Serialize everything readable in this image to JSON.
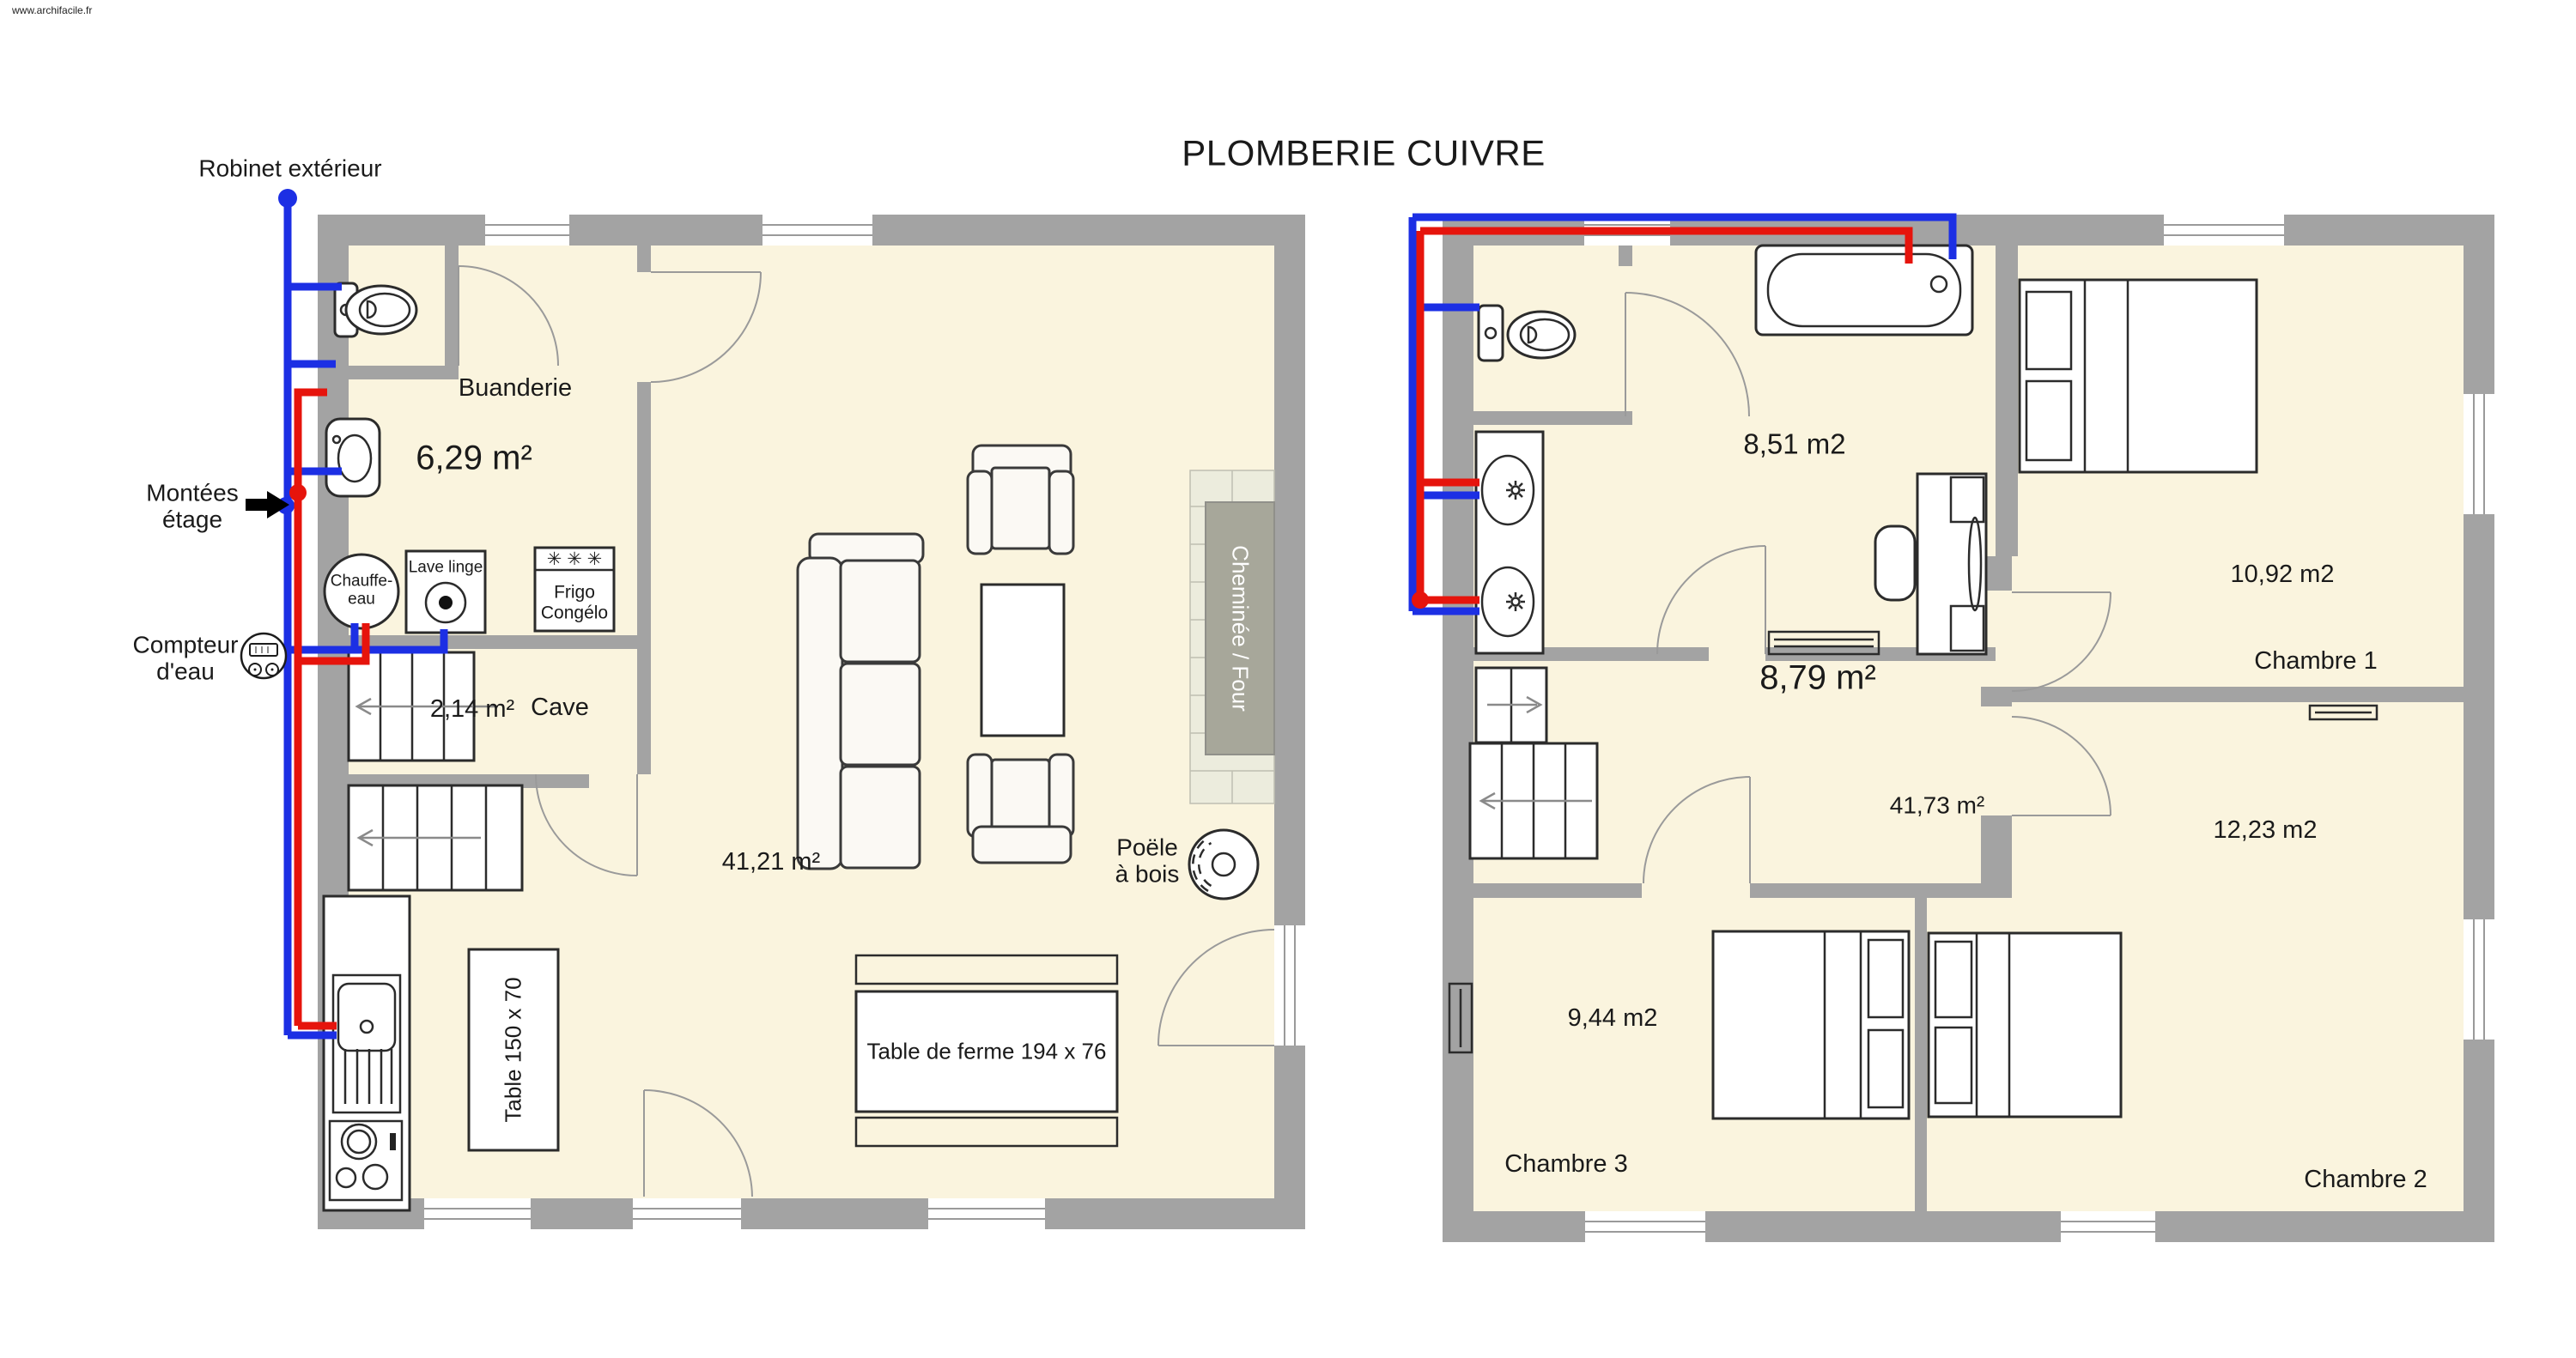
{
  "labels": {
    "watermark": "www.archifacile.fr",
    "title": "PLOMBERIE CUIVRE",
    "outdoor_tap": "Robinet extérieur",
    "risers": [
      "Montées",
      "étage"
    ],
    "water_meter": [
      "Compteur",
      "d'eau"
    ]
  },
  "ground_floor": {
    "room": "Buanderie",
    "room_area": "6,29 m²",
    "heater": [
      "Chauffe-",
      "eau"
    ],
    "washer": "Lave linge",
    "fridge_stars": "✳ ✳ ✳",
    "fridge": [
      "Frigo",
      "Congélo"
    ],
    "cellar": "Cave",
    "cellar_area": "2,14 m²",
    "living_area": "41,21 m²",
    "small_table": "Table 150 x 70",
    "farm_table": "Table de ferme 194 x 76",
    "wood_stove": [
      "Poële",
      "à bois"
    ],
    "fireplace": "Cheminée / Four"
  },
  "upper_floor": {
    "bathroom_area": "8,51 m2",
    "landing_area": "8,79 m²",
    "total_area": "41,73 m²",
    "bedroom1": "Chambre 1",
    "bedroom1_area": "10,92 m2",
    "bedroom2": "Chambre 2",
    "bedroom2_area": "12,23 m2",
    "bedroom3": "Chambre 3",
    "bedroom3_area": "9,44 m2"
  },
  "colors": {
    "pipe_cold": "#1C2FE4",
    "pipe_hot": "#E6140C",
    "wall": "#A3A3A3",
    "floor": "#FAF4DE",
    "fireplace_block": "#A7A79A",
    "hearth": "#ECECDD"
  }
}
